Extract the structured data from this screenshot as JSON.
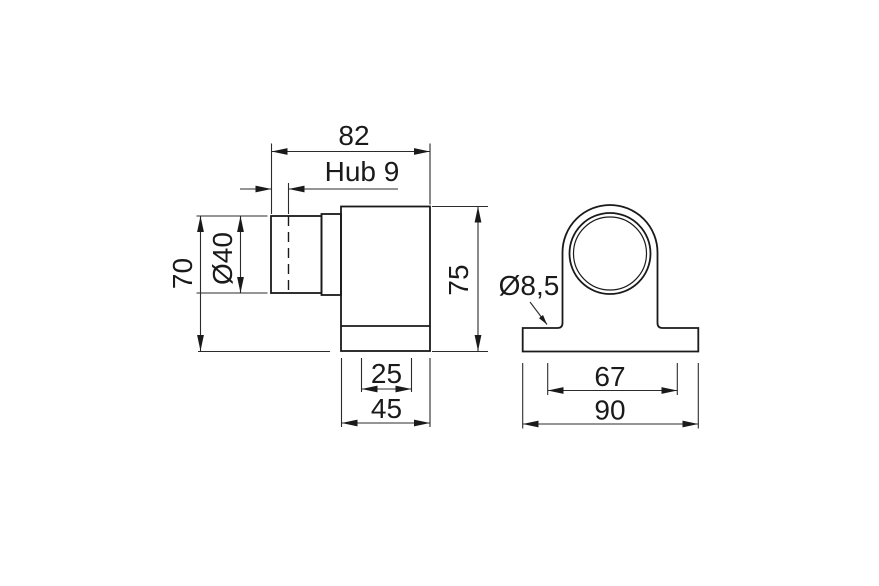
{
  "colors": {
    "background": "#ffffff",
    "object_line": "#1a1a1a",
    "dimension_line": "#2b2b2b",
    "text": "#1a1a1a"
  },
  "drawing": {
    "kind": "technical dimension drawing, two orthographic views of a clamp bracket with cylinder and mounting foot"
  },
  "dimensions": {
    "overall_length": "82",
    "stroke": "Hub 9",
    "rod_diameter": "Ø40",
    "rod_top_to_base": "70",
    "body_height": "75",
    "slot_width": "25",
    "body_width": "45",
    "hole_diameter": "Ø8,5",
    "hole_spacing": "67",
    "base_width": "90"
  }
}
